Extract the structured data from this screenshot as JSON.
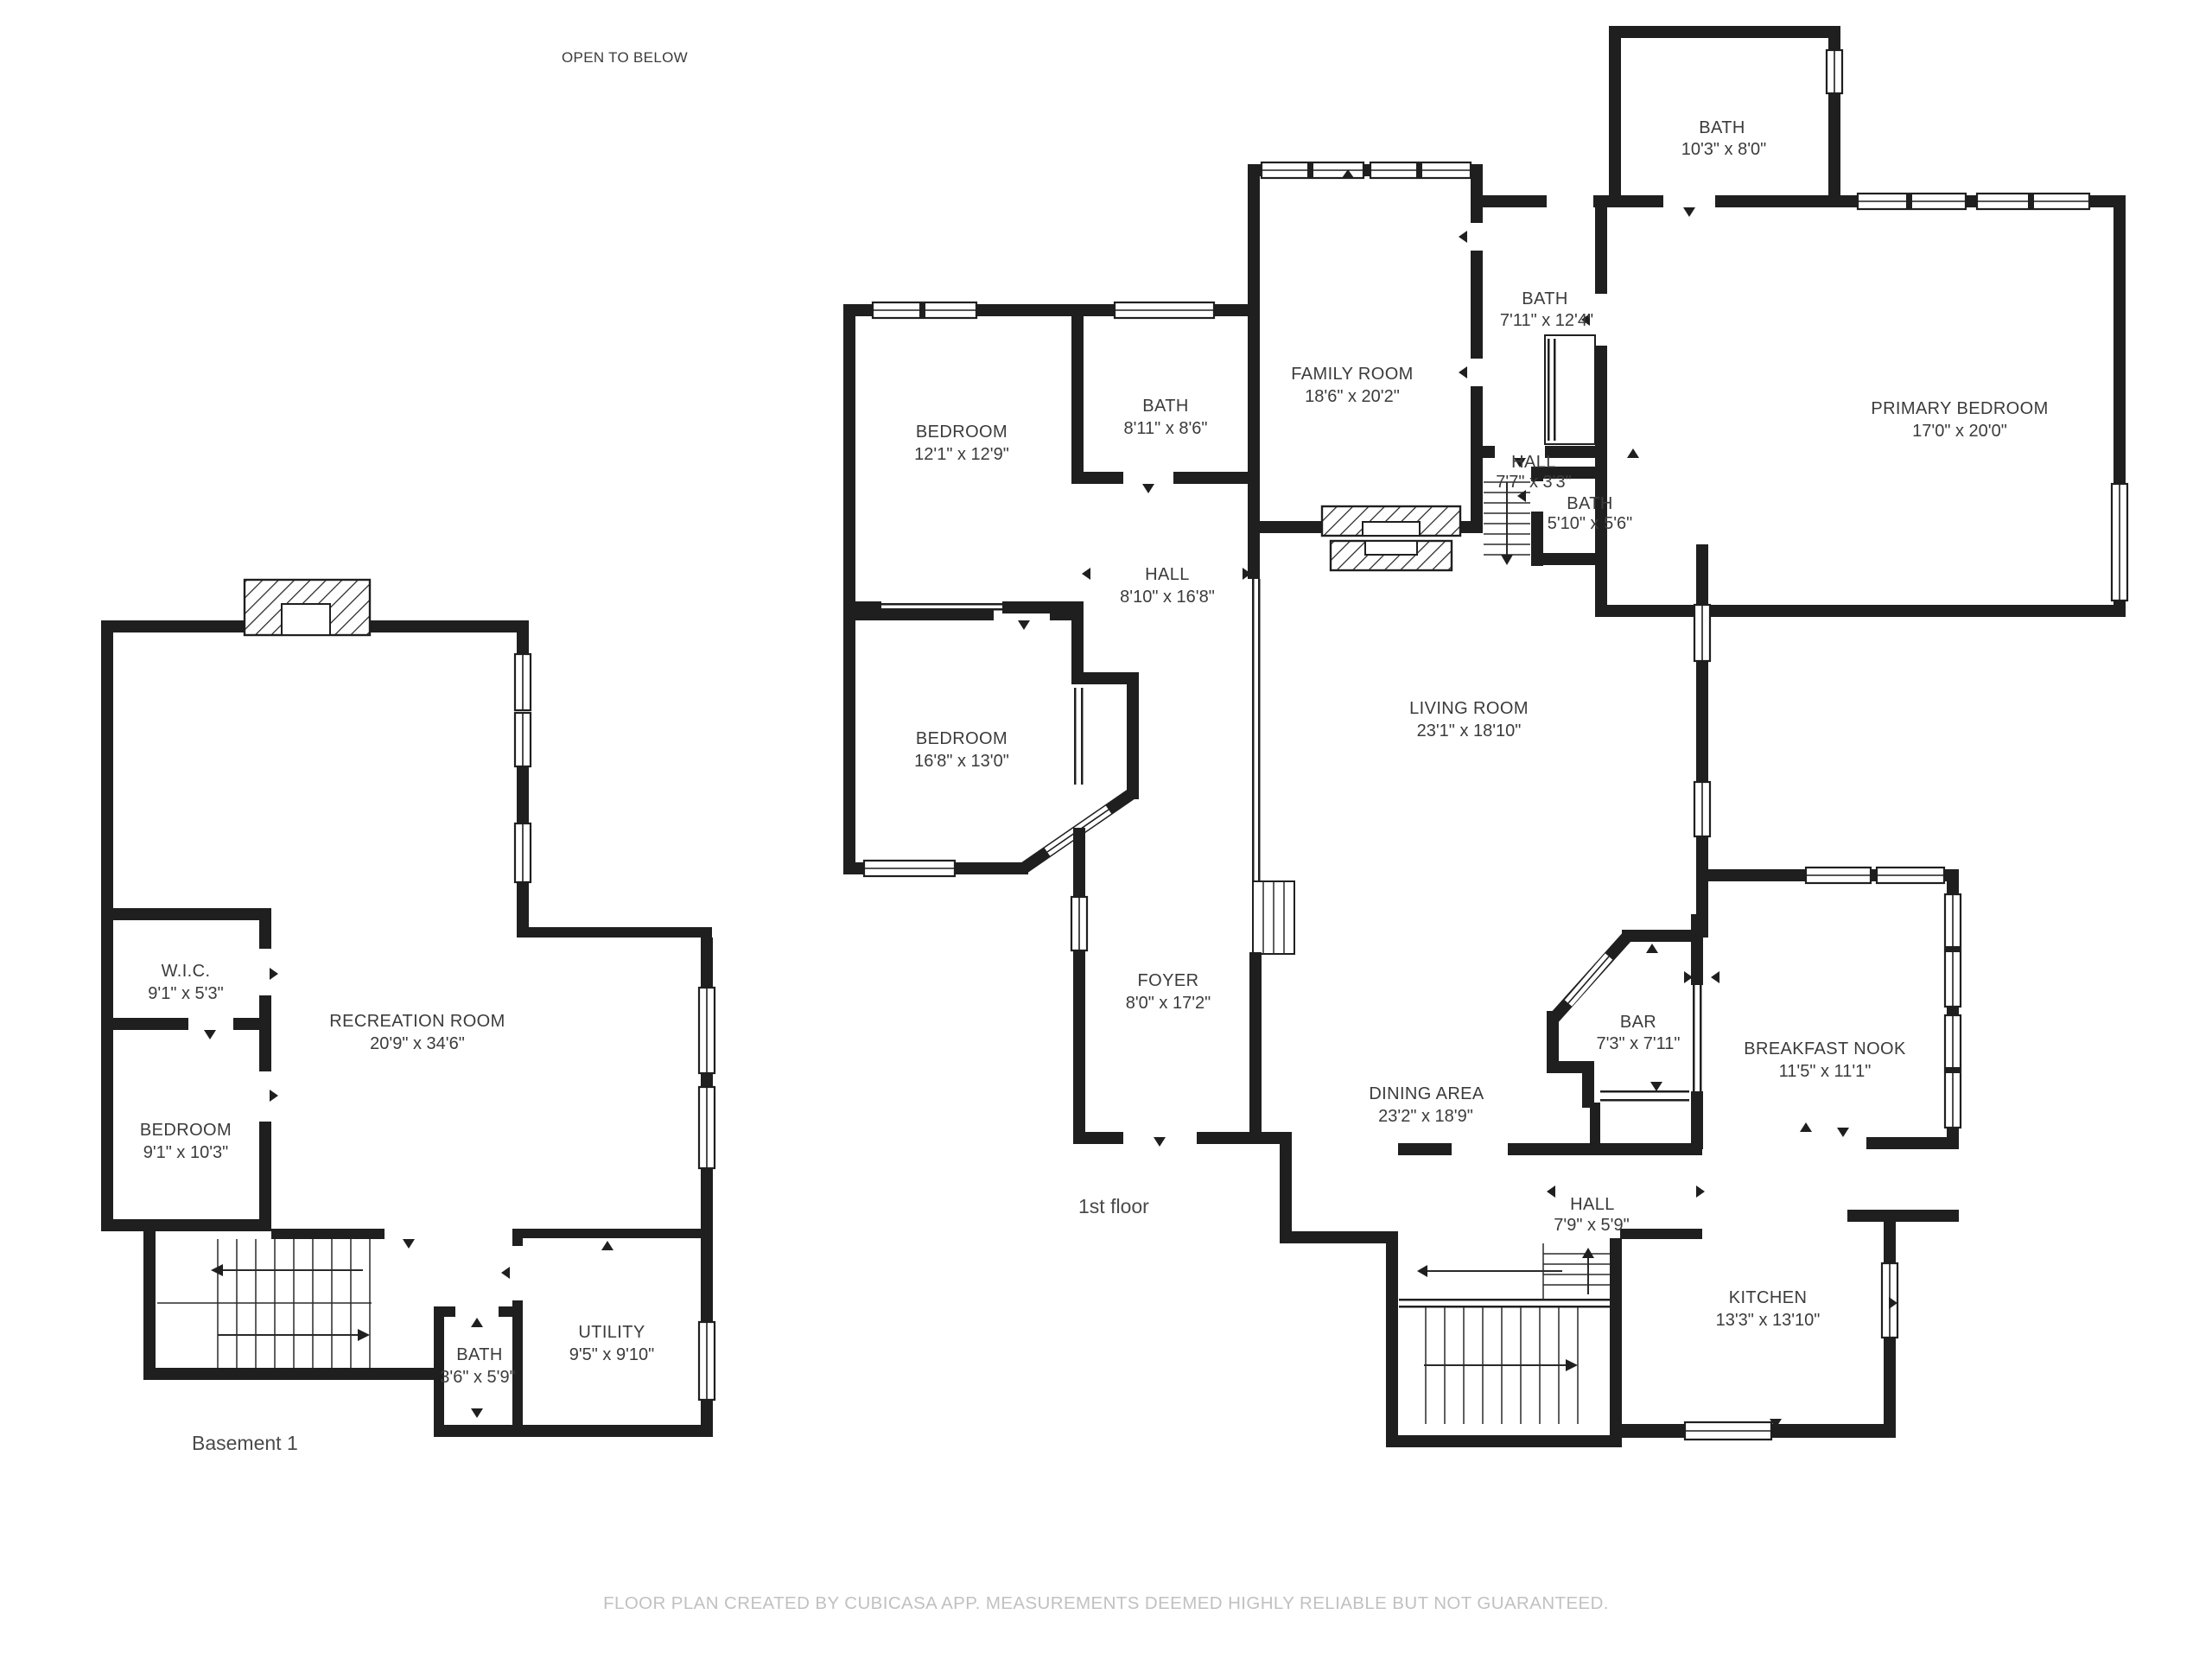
{
  "floor_plan": {
    "annotations": {
      "open_to_below": "OPEN TO BELOW"
    },
    "floor_labels": {
      "basement": "Basement 1",
      "first": "1st floor"
    },
    "rooms": {
      "bsmt_wic": {
        "name": "W.I.C.",
        "dims": "9'1\" x 5'3\""
      },
      "bsmt_bedroom": {
        "name": "BEDROOM",
        "dims": "9'1\" x 10'3\""
      },
      "bsmt_rec": {
        "name": "RECREATION ROOM",
        "dims": "20'9\" x 34'6\""
      },
      "bsmt_bath": {
        "name": "BATH",
        "dims": "3'6\" x 5'9\""
      },
      "bsmt_utility": {
        "name": "UTILITY",
        "dims": "9'5\" x 9'10\""
      },
      "bedroom1": {
        "name": "BEDROOM",
        "dims": "12'1\" x 12'9\""
      },
      "bath_ul": {
        "name": "BATH",
        "dims": "8'11\" x 8'6\""
      },
      "hall_upper": {
        "name": "HALL",
        "dims": "8'10\" x 16'8\""
      },
      "bedroom2": {
        "name": "BEDROOM",
        "dims": "16'8\" x 13'0\""
      },
      "family": {
        "name": "FAMILY ROOM",
        "dims": "18'6\" x 20'2\""
      },
      "bath_top": {
        "name": "BATH",
        "dims": "10'3\" x 8'0\""
      },
      "bath_711": {
        "name": "BATH",
        "dims": "7'11\" x 12'4\""
      },
      "primary": {
        "name": "PRIMARY BEDROOM",
        "dims": "17'0\" x 20'0\""
      },
      "hall_77": {
        "name": "HALL",
        "dims": "7'7\" x 3'3\""
      },
      "bath_510": {
        "name": "BATH",
        "dims": "5'10\" x 5'6\""
      },
      "living": {
        "name": "LIVING ROOM",
        "dims": "23'1\" x 18'10\""
      },
      "foyer": {
        "name": "FOYER",
        "dims": "8'0\" x 17'2\""
      },
      "dining": {
        "name": "DINING AREA",
        "dims": "23'2\" x 18'9\""
      },
      "bar": {
        "name": "BAR",
        "dims": "7'3\" x 7'11\""
      },
      "nook": {
        "name": "BREAKFAST NOOK",
        "dims": "11'5\" x 11'1\""
      },
      "hall_79": {
        "name": "HALL",
        "dims": "7'9\" x 5'9\""
      },
      "kitchen": {
        "name": "KITCHEN",
        "dims": "13'3\" x 13'10\""
      }
    },
    "disclaimer": "FLOOR PLAN CREATED BY CUBICASA APP. MEASUREMENTS DEEMED HIGHLY RELIABLE BUT NOT GUARANTEED.",
    "colors": {
      "wall": "#1f1f1f",
      "label": "#3b3b3b",
      "floor_label": "#4a4a4a",
      "disclaimer": "#c1c1c1"
    }
  }
}
